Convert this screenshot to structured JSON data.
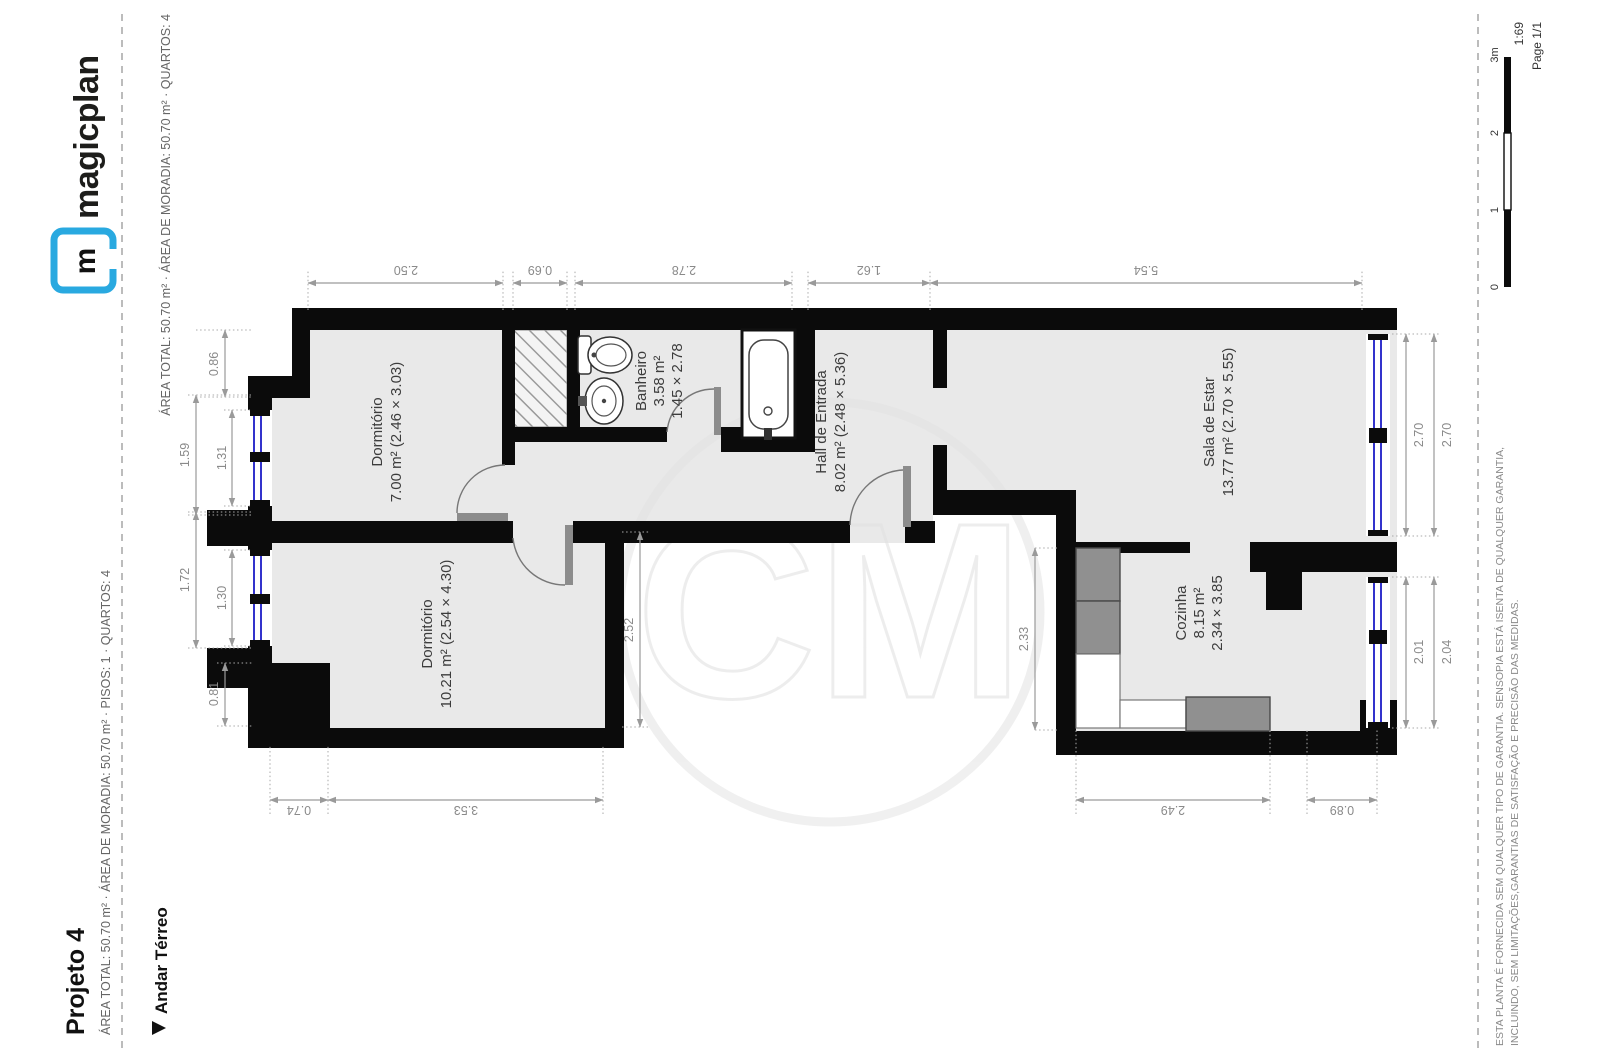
{
  "header": {
    "title": "Projeto 4",
    "subtitle": "ÁREA TOTAL: 50.70 m² · ÁREA DE MORADIA: 50.70 m² · PISOS: 1 · QUARTOS: 4",
    "brand": "magicplan",
    "brand_icon_letter": "m",
    "brand_color": "#29a9e0"
  },
  "floor_row": {
    "floor_label": "Andar Térreo",
    "floor_summary": "ÁREA TOTAL: 50.70 m² · ÁREA DE MORADIA: 50.70 m² · QUARTOS: 4"
  },
  "rooms": [
    {
      "name": "Dormitório",
      "line2": "7.00 m² (2.46 × 3.03)"
    },
    {
      "name": "Dormitório",
      "line2": "10.21 m² (2.54 × 4.30)"
    },
    {
      "name": "Banheiro",
      "line2": "3.58 m²",
      "line3": "1.45 × 2.78"
    },
    {
      "name": "Hall de Entrada",
      "line2": "8.02 m² (2.48 × 5.36)"
    },
    {
      "name": "Sala de Estar",
      "line2": "13.77 m² (2.70 × 5.55)"
    },
    {
      "name": "Cozinha",
      "line2": "8.15 m²",
      "line3": "2.34 × 3.85"
    }
  ],
  "dimensions": {
    "top": [
      "2.50",
      "0.69",
      "2.78",
      "1.62",
      "5.54"
    ],
    "left": [
      "0.86",
      "1.59",
      "1.31",
      "1.72",
      "1.30",
      "0.81"
    ],
    "bottom": [
      "0.74",
      "3.53",
      "2.49",
      "0.89"
    ],
    "right": [
      "2.70",
      "2.70",
      "2.01",
      "2.04"
    ],
    "inner": [
      "2.52",
      "2.33"
    ]
  },
  "watermark": "CM",
  "footer": {
    "disclaimer1": "ESTA PLANTA É FORNECIDA SEM QUALQUER TIPO DE GARANTIA. SENSOPIA ESTÁ ISENTA DE QUALQUER GARANTIA,",
    "disclaimer2": "INCLUINDO, SEM LIMITAÇÕES,GARANTIAS DE SATISFAÇÃO E PRECISÃO DAS MEDIDAS.",
    "scale_ticks": [
      "0",
      "1",
      "2",
      "3m"
    ],
    "scale_ratio": "1:69",
    "page_label": "Page 1/1"
  }
}
